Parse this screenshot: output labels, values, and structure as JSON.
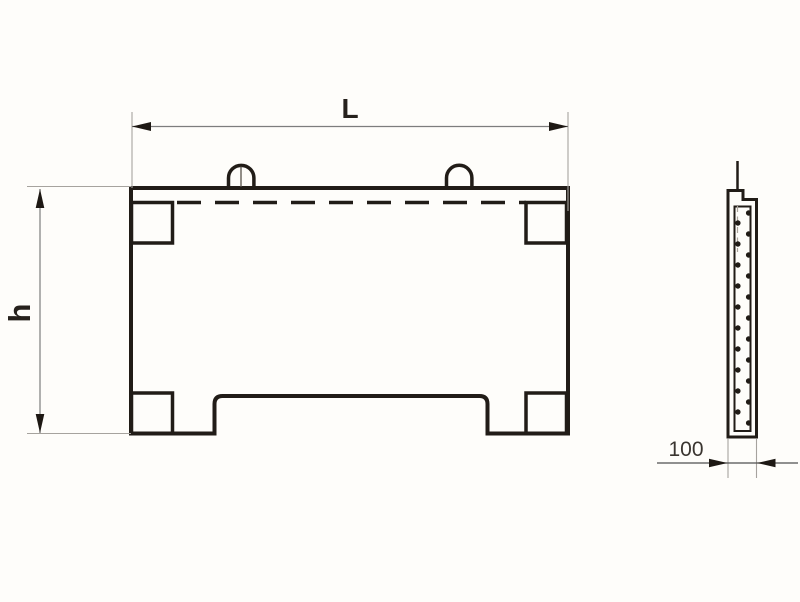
{
  "meta": {
    "type": "technical-drawing",
    "subject": "reinforced concrete fence panel: front elevation and side cross-section"
  },
  "colors": {
    "background": "#fefdfa",
    "outline_ink": "#211c17",
    "dimension_line": "#7d7d7d",
    "extension_line": "#a6a39e",
    "label_text": "#26211c"
  },
  "dimensions": {
    "length_label": "L",
    "height_label": "h",
    "thickness_label": "100"
  }
}
